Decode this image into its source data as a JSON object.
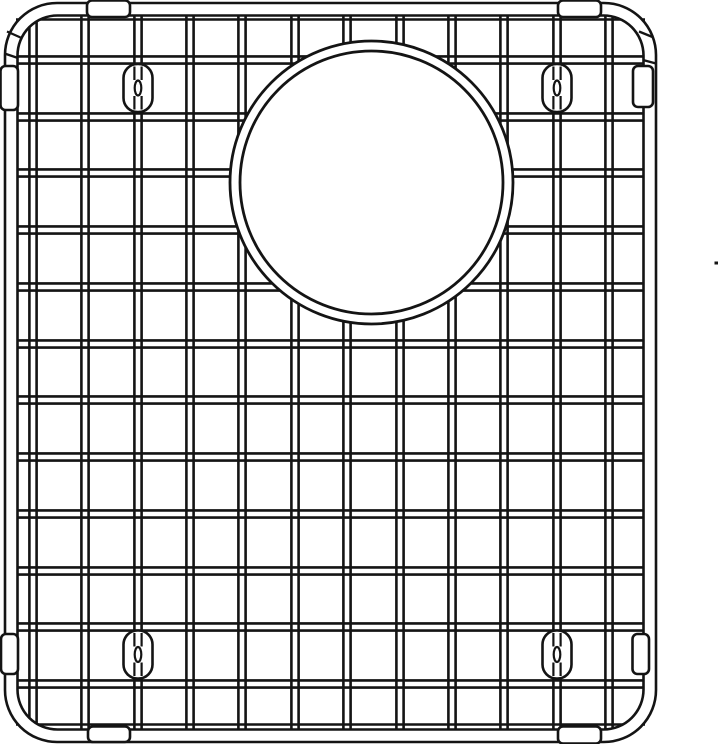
{
  "meta": {
    "description": "Line drawing of a stainless sink bottom grid with circular drain opening",
    "canvas": {
      "width": 720,
      "height": 744
    },
    "colors": {
      "line": "#141414",
      "fill": "#ffffff"
    }
  },
  "frame": {
    "outer": {
      "x": 5,
      "y": 3,
      "w": 651,
      "h": 739,
      "r": 52
    },
    "inner": {
      "x": 17.5,
      "y": 15.5,
      "w": 626,
      "h": 714,
      "r": 40
    },
    "stroke": 2.6,
    "seam_stroke": 2.3,
    "seams": [
      {
        "x1": 7,
        "y1": 31.5,
        "x2": 20.5,
        "y2": 37.5
      },
      {
        "x1": 4.5,
        "y1": 53.5,
        "x2": 18,
        "y2": 58
      },
      {
        "x1": 639,
        "y1": 31.5,
        "x2": 652.5,
        "y2": 37
      },
      {
        "x1": 643,
        "y1": 60,
        "x2": 656,
        "y2": 63.5
      }
    ]
  },
  "grid": {
    "v_wire_x": [
      33,
      85,
      138,
      190,
      242,
      295,
      347,
      400,
      452,
      504,
      557,
      609
    ],
    "h_wire_y": [
      60,
      117,
      173,
      230,
      287,
      344,
      400,
      457,
      514,
      571,
      627,
      684
    ],
    "line_offset": 3.6,
    "line_width": 2.6,
    "v_y1": 15,
    "v_y2": 730,
    "h_x1": 16,
    "h_x2": 645,
    "top_rail_y": 19.5,
    "bottom_rail_y": 724.5
  },
  "drain_opening": {
    "cx": 371.5,
    "cy": 182.5,
    "r_outer": 141.5,
    "r_inner": 131.5,
    "stroke": 2.8
  },
  "feet": {
    "size": {
      "w": 29,
      "h": 48,
      "rx": 14,
      "stroke": 2.6
    },
    "link": {
      "rx": 3.3,
      "ry": 7.5,
      "gap": 8,
      "stroke": 2.2
    },
    "positions": [
      {
        "side": "top-left",
        "cx": 138,
        "cy": 88
      },
      {
        "side": "top-right",
        "cx": 557,
        "cy": 88
      },
      {
        "side": "bottom-left",
        "cx": 138,
        "cy": 654.5
      },
      {
        "side": "bottom-right",
        "cx": 557,
        "cy": 654.5
      }
    ]
  },
  "bumpers": {
    "stroke": 2.6,
    "items": [
      {
        "side": "top-left",
        "x": 87,
        "y": 0.5,
        "w": 43,
        "h": 16.5,
        "rx": 5
      },
      {
        "side": "top-right",
        "x": 558,
        "y": 0.5,
        "w": 43,
        "h": 16.5,
        "rx": 5
      },
      {
        "side": "bottom-left",
        "x": 88,
        "y": 726.5,
        "w": 42,
        "h": 15.5,
        "rx": 5
      },
      {
        "side": "bottom-right",
        "x": 558,
        "y": 726.5,
        "w": 43,
        "h": 17,
        "rx": 5
      },
      {
        "side": "left-top",
        "x": 0.5,
        "y": 66,
        "w": 17.5,
        "h": 44,
        "rx": 5
      },
      {
        "side": "left-bottom",
        "x": 1,
        "y": 634,
        "w": 17,
        "h": 40,
        "rx": 5
      },
      {
        "side": "right-top",
        "x": 633,
        "y": 66,
        "w": 20,
        "h": 41,
        "rx": 5
      },
      {
        "side": "right-bottom",
        "x": 632.5,
        "y": 634,
        "w": 16.5,
        "h": 40,
        "rx": 5
      }
    ]
  },
  "stray_mark": {
    "x": 714.5,
    "y": 261.5,
    "w": 3.5,
    "h": 3
  }
}
